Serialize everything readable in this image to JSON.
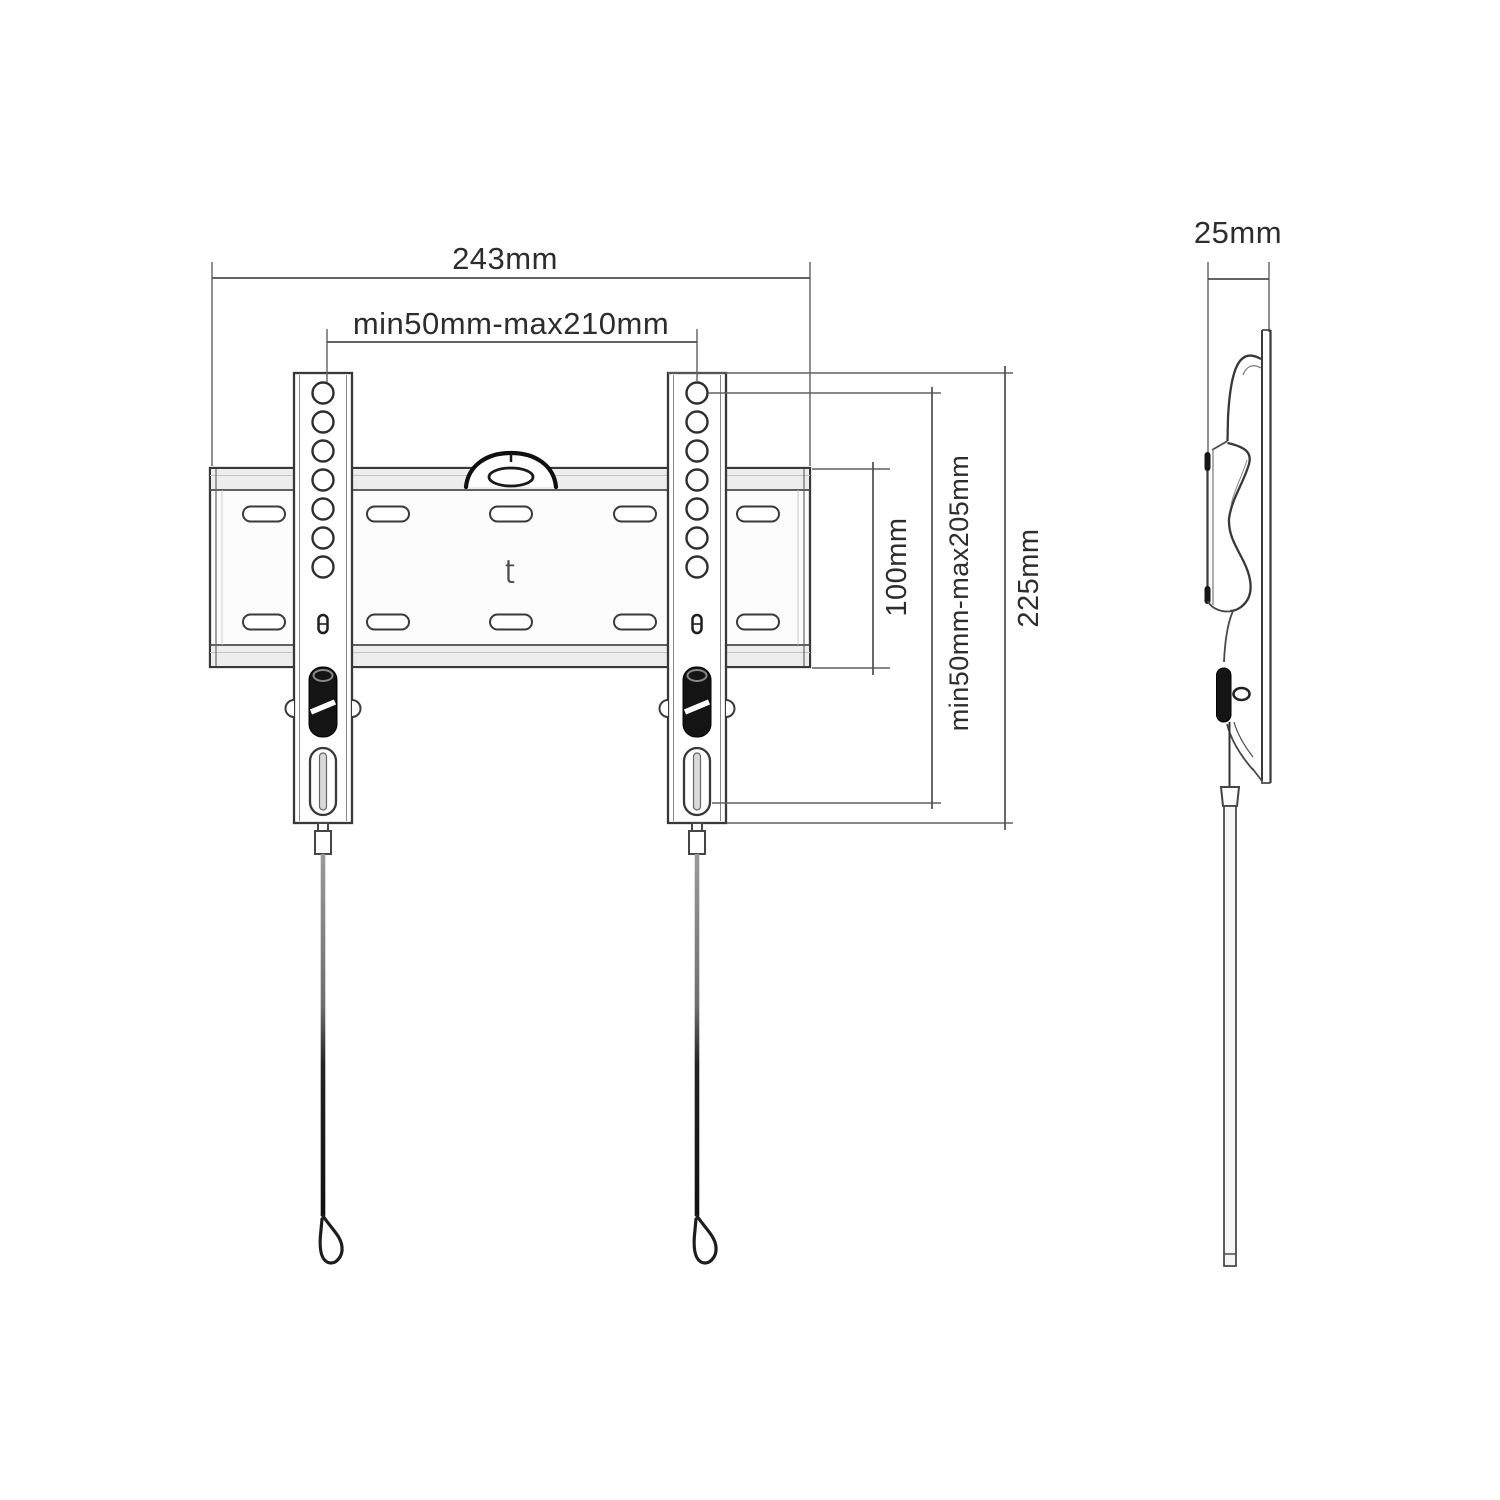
{
  "canvas": {
    "width": 1500,
    "height": 1500,
    "background": "#ffffff"
  },
  "colors": {
    "outline": "#383838",
    "inner_line": "#8a8a8a",
    "dimension": "#4d4d4d",
    "text": "#2d2d2d",
    "lever": "#141414",
    "flange_shade": "#ededed",
    "cord_dark": "#1a1a1a",
    "cord_light": "#9a9a9a"
  },
  "front_view": {
    "dimensions": {
      "total_width": "243mm",
      "vesa_width_range": "min50mm-max210mm",
      "plate_height": "100mm",
      "vesa_height_range": "min50mm-max205mm",
      "bracket_height": "225mm"
    }
  },
  "side_view": {
    "dimensions": {
      "depth": "25mm"
    }
  },
  "logo_glyph": "ʈ"
}
